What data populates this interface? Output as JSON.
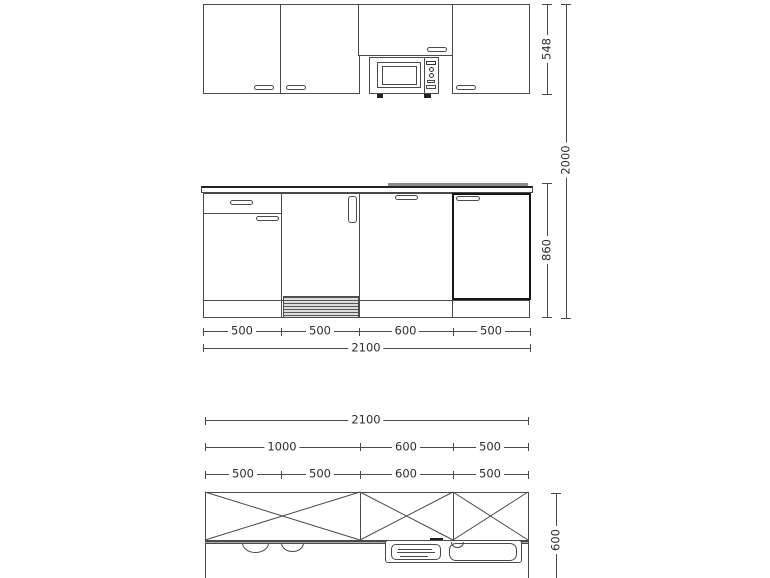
{
  "colors": {
    "line": "#4a4a4a",
    "bold_line": "#161616",
    "text": "#2e2e2e",
    "background": "#ffffff",
    "vent_fill": "#9a9a9a"
  },
  "front_elevation": {
    "upper_cabinet_height": "548",
    "total_height": "2000",
    "base_cabinet_height": "860",
    "segment_widths": [
      "500",
      "500",
      "600",
      "500"
    ],
    "total_width": "2100"
  },
  "plan_view": {
    "total_width": "2100",
    "group_widths": [
      "1000",
      "600",
      "500"
    ],
    "segment_widths": [
      "500",
      "500",
      "600",
      "500"
    ],
    "worktop_depth": "600"
  }
}
